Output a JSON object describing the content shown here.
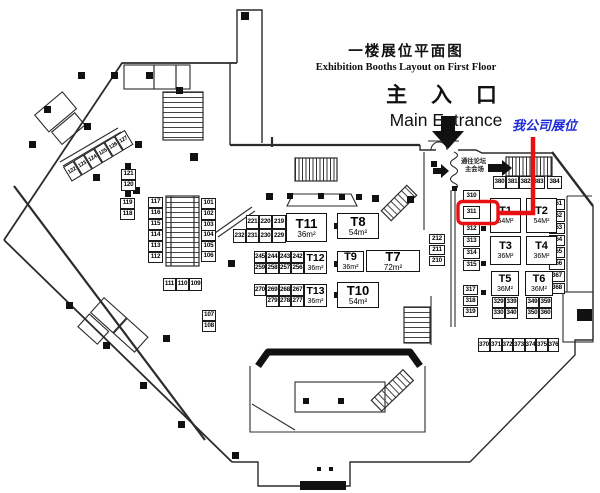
{
  "title": {
    "zh": "一楼展位平面图",
    "en": "Exhibition Booths Layout on First Floor"
  },
  "entrance": {
    "zh": "主 入 口",
    "en": "Main Entrance"
  },
  "company_annotation": {
    "label": "我公司展位",
    "highlighted_booth": "311",
    "text_color": "#1d2bd8",
    "line_color": "#e81012"
  },
  "forum_sign": {
    "line1": "通往论坛",
    "line2": "主会场"
  },
  "halls": [
    {
      "id": "T11",
      "area": "36m²",
      "x": 286,
      "y": 213,
      "w": 41,
      "h": 29
    },
    {
      "id": "T8",
      "area": "54m²",
      "x": 337,
      "y": 213,
      "w": 42,
      "h": 26
    },
    {
      "id": "T12",
      "area": "36m²",
      "x": 304,
      "y": 251,
      "w": 23,
      "h": 23
    },
    {
      "id": "T9",
      "area": "36m²",
      "x": 337,
      "y": 251,
      "w": 27,
      "h": 21
    },
    {
      "id": "T7",
      "area": "72m²",
      "x": 366,
      "y": 250,
      "w": 54,
      "h": 22
    },
    {
      "id": "T13",
      "area": "36m²",
      "x": 304,
      "y": 284,
      "w": 23,
      "h": 23
    },
    {
      "id": "T10",
      "area": "54m²",
      "x": 337,
      "y": 282,
      "w": 42,
      "h": 26
    },
    {
      "id": "T1",
      "area": "54M²",
      "x": 490,
      "y": 198,
      "w": 31,
      "h": 35
    },
    {
      "id": "T2",
      "area": "54M²",
      "x": 526,
      "y": 198,
      "w": 31,
      "h": 35
    },
    {
      "id": "T3",
      "area": "36M²",
      "x": 490,
      "y": 236,
      "w": 31,
      "h": 29
    },
    {
      "id": "T4",
      "area": "36M²",
      "x": 526,
      "y": 236,
      "w": 31,
      "h": 29
    },
    {
      "id": "T5",
      "area": "36M²",
      "x": 491,
      "y": 271,
      "w": 28,
      "h": 25
    },
    {
      "id": "T6",
      "area": "36M²",
      "x": 525,
      "y": 271,
      "w": 28,
      "h": 25
    }
  ],
  "booths": [
    {
      "n": "121",
      "x": 121,
      "y": 169,
      "w": 15,
      "h": 11
    },
    {
      "n": "120",
      "x": 121,
      "y": 180,
      "w": 15,
      "h": 11
    },
    {
      "n": "119",
      "x": 120,
      "y": 198,
      "w": 15,
      "h": 11
    },
    {
      "n": "118",
      "x": 120,
      "y": 209,
      "w": 15,
      "h": 11
    },
    {
      "n": "117",
      "x": 148,
      "y": 197,
      "w": 15,
      "h": 11
    },
    {
      "n": "116",
      "x": 148,
      "y": 208,
      "w": 15,
      "h": 11
    },
    {
      "n": "115",
      "x": 148,
      "y": 219,
      "w": 15,
      "h": 11
    },
    {
      "n": "114",
      "x": 148,
      "y": 230,
      "w": 15,
      "h": 11
    },
    {
      "n": "113",
      "x": 148,
      "y": 241,
      "w": 15,
      "h": 11
    },
    {
      "n": "112",
      "x": 148,
      "y": 252,
      "w": 15,
      "h": 11
    },
    {
      "n": "101",
      "x": 201,
      "y": 198,
      "w": 15,
      "h": 11
    },
    {
      "n": "102",
      "x": 201,
      "y": 209,
      "w": 15,
      "h": 11
    },
    {
      "n": "103",
      "x": 201,
      "y": 220,
      "w": 15,
      "h": 11
    },
    {
      "n": "104",
      "x": 201,
      "y": 230,
      "w": 15,
      "h": 11
    },
    {
      "n": "105",
      "x": 201,
      "y": 241,
      "w": 15,
      "h": 11
    },
    {
      "n": "106",
      "x": 201,
      "y": 251,
      "w": 15,
      "h": 11
    },
    {
      "n": "111",
      "x": 163,
      "y": 278,
      "w": 13,
      "h": 13
    },
    {
      "n": "110",
      "x": 176,
      "y": 278,
      "w": 13,
      "h": 13
    },
    {
      "n": "109",
      "x": 189,
      "y": 278,
      "w": 13,
      "h": 13
    },
    {
      "n": "107",
      "x": 202,
      "y": 310,
      "w": 14,
      "h": 11
    },
    {
      "n": "108",
      "x": 202,
      "y": 321,
      "w": 14,
      "h": 11
    },
    {
      "n": "221",
      "x": 246,
      "y": 215,
      "w": 13,
      "h": 14
    },
    {
      "n": "220",
      "x": 259,
      "y": 215,
      "w": 13,
      "h": 14
    },
    {
      "n": "219",
      "x": 272,
      "y": 215,
      "w": 14,
      "h": 14
    },
    {
      "n": "232",
      "x": 233,
      "y": 229,
      "w": 13,
      "h": 14
    },
    {
      "n": "231",
      "x": 246,
      "y": 229,
      "w": 13,
      "h": 14
    },
    {
      "n": "230",
      "x": 259,
      "y": 229,
      "w": 13,
      "h": 14
    },
    {
      "n": "229",
      "x": 272,
      "y": 229,
      "w": 14,
      "h": 14
    },
    {
      "n": "245",
      "x": 254,
      "y": 251,
      "w": 12,
      "h": 12
    },
    {
      "n": "244",
      "x": 266,
      "y": 251,
      "w": 13,
      "h": 12
    },
    {
      "n": "243",
      "x": 279,
      "y": 251,
      "w": 12,
      "h": 12
    },
    {
      "n": "242",
      "x": 291,
      "y": 251,
      "w": 13,
      "h": 12
    },
    {
      "n": "259",
      "x": 254,
      "y": 263,
      "w": 12,
      "h": 11
    },
    {
      "n": "258",
      "x": 266,
      "y": 263,
      "w": 13,
      "h": 11
    },
    {
      "n": "257",
      "x": 279,
      "y": 263,
      "w": 12,
      "h": 11
    },
    {
      "n": "256",
      "x": 291,
      "y": 263,
      "w": 13,
      "h": 11
    },
    {
      "n": "270",
      "x": 254,
      "y": 284,
      "w": 12,
      "h": 12
    },
    {
      "n": "269",
      "x": 266,
      "y": 284,
      "w": 13,
      "h": 12
    },
    {
      "n": "268",
      "x": 279,
      "y": 284,
      "w": 12,
      "h": 12
    },
    {
      "n": "267",
      "x": 291,
      "y": 284,
      "w": 13,
      "h": 12
    },
    {
      "n": "279",
      "x": 266,
      "y": 296,
      "w": 13,
      "h": 11
    },
    {
      "n": "278",
      "x": 279,
      "y": 296,
      "w": 12,
      "h": 11
    },
    {
      "n": "277",
      "x": 291,
      "y": 296,
      "w": 13,
      "h": 11
    },
    {
      "n": "380",
      "x": 493,
      "y": 176,
      "w": 13,
      "h": 13
    },
    {
      "n": "381",
      "x": 506,
      "y": 176,
      "w": 13,
      "h": 13
    },
    {
      "n": "382",
      "x": 519,
      "y": 176,
      "w": 13,
      "h": 13
    },
    {
      "n": "383",
      "x": 532,
      "y": 176,
      "w": 13,
      "h": 13
    },
    {
      "n": "384",
      "x": 547,
      "y": 176,
      "w": 15,
      "h": 13
    },
    {
      "n": "310",
      "x": 463,
      "y": 190,
      "w": 17,
      "h": 13
    },
    {
      "n": "311",
      "x": 463,
      "y": 206,
      "w": 17,
      "h": 13
    },
    {
      "n": "312",
      "x": 463,
      "y": 223,
      "w": 17,
      "h": 12
    },
    {
      "n": "313",
      "x": 463,
      "y": 236,
      "w": 17,
      "h": 11
    },
    {
      "n": "314",
      "x": 463,
      "y": 248,
      "w": 17,
      "h": 11
    },
    {
      "n": "315",
      "x": 463,
      "y": 260,
      "w": 17,
      "h": 11
    },
    {
      "n": "317",
      "x": 463,
      "y": 285,
      "w": 15,
      "h": 10
    },
    {
      "n": "318",
      "x": 463,
      "y": 296,
      "w": 15,
      "h": 10
    },
    {
      "n": "319",
      "x": 463,
      "y": 307,
      "w": 15,
      "h": 10
    },
    {
      "n": "212",
      "x": 429,
      "y": 234,
      "w": 16,
      "h": 10
    },
    {
      "n": "211",
      "x": 429,
      "y": 245,
      "w": 16,
      "h": 10
    },
    {
      "n": "210",
      "x": 429,
      "y": 256,
      "w": 16,
      "h": 10
    },
    {
      "n": "361",
      "x": 549,
      "y": 199,
      "w": 16,
      "h": 11
    },
    {
      "n": "362",
      "x": 549,
      "y": 211,
      "w": 16,
      "h": 11
    },
    {
      "n": "363",
      "x": 549,
      "y": 223,
      "w": 16,
      "h": 11
    },
    {
      "n": "364",
      "x": 549,
      "y": 235,
      "w": 16,
      "h": 11
    },
    {
      "n": "365",
      "x": 549,
      "y": 247,
      "w": 16,
      "h": 11
    },
    {
      "n": "366",
      "x": 549,
      "y": 259,
      "w": 16,
      "h": 11
    },
    {
      "n": "367",
      "x": 549,
      "y": 271,
      "w": 16,
      "h": 11
    },
    {
      "n": "368",
      "x": 549,
      "y": 283,
      "w": 16,
      "h": 11
    },
    {
      "n": "329",
      "x": 492,
      "y": 297,
      "w": 13,
      "h": 11
    },
    {
      "n": "339",
      "x": 505,
      "y": 297,
      "w": 13,
      "h": 11
    },
    {
      "n": "330",
      "x": 492,
      "y": 308,
      "w": 13,
      "h": 11
    },
    {
      "n": "340",
      "x": 505,
      "y": 308,
      "w": 13,
      "h": 11
    },
    {
      "n": "349",
      "x": 526,
      "y": 297,
      "w": 13,
      "h": 11
    },
    {
      "n": "359",
      "x": 539,
      "y": 297,
      "w": 13,
      "h": 11
    },
    {
      "n": "350",
      "x": 526,
      "y": 308,
      "w": 13,
      "h": 11
    },
    {
      "n": "360",
      "x": 539,
      "y": 308,
      "w": 13,
      "h": 11
    },
    {
      "n": "370",
      "x": 478,
      "y": 338,
      "w": 12,
      "h": 14
    },
    {
      "n": "371",
      "x": 490,
      "y": 338,
      "w": 12,
      "h": 14
    },
    {
      "n": "372",
      "x": 502,
      "y": 338,
      "w": 11,
      "h": 14
    },
    {
      "n": "373",
      "x": 513,
      "y": 338,
      "w": 12,
      "h": 14
    },
    {
      "n": "374",
      "x": 525,
      "y": 338,
      "w": 11,
      "h": 14
    },
    {
      "n": "375",
      "x": 536,
      "y": 338,
      "w": 12,
      "h": 14
    },
    {
      "n": "376",
      "x": 548,
      "y": 338,
      "w": 11,
      "h": 14
    }
  ],
  "diagonal_booths": [
    "122",
    "123",
    "124",
    "125",
    "126",
    "127"
  ]
}
